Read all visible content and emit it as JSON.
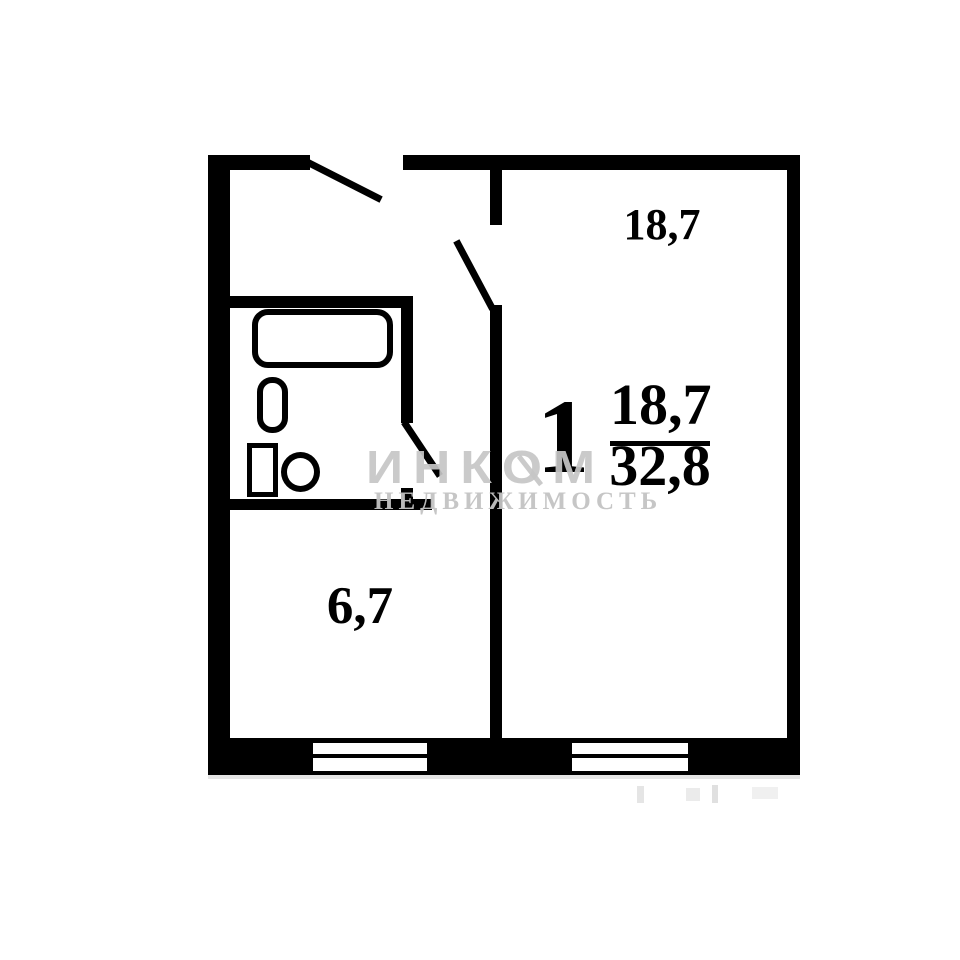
{
  "rooms": {
    "living": {
      "area": "18,7"
    },
    "kitchen": {
      "area": "6,7"
    }
  },
  "apartment": {
    "rooms_count": "1",
    "living_area": "18,7",
    "total_area": "32,8"
  },
  "watermark": {
    "brand": "ИНКОМ",
    "tagline": "НЕДВИЖИМОСТЬ"
  },
  "colors": {
    "wall": "#000000",
    "background": "#ffffff",
    "watermark": "#c6c6c6"
  },
  "icons": {
    "fixtures": [
      "bathtub-icon",
      "sink-icon",
      "toilet-icon"
    ],
    "doors": [
      "entrance-door-swing-icon",
      "living-room-door-swing-icon",
      "bathroom-door-swing-icon"
    ],
    "windows": [
      "kitchen-window",
      "living-room-window"
    ]
  }
}
